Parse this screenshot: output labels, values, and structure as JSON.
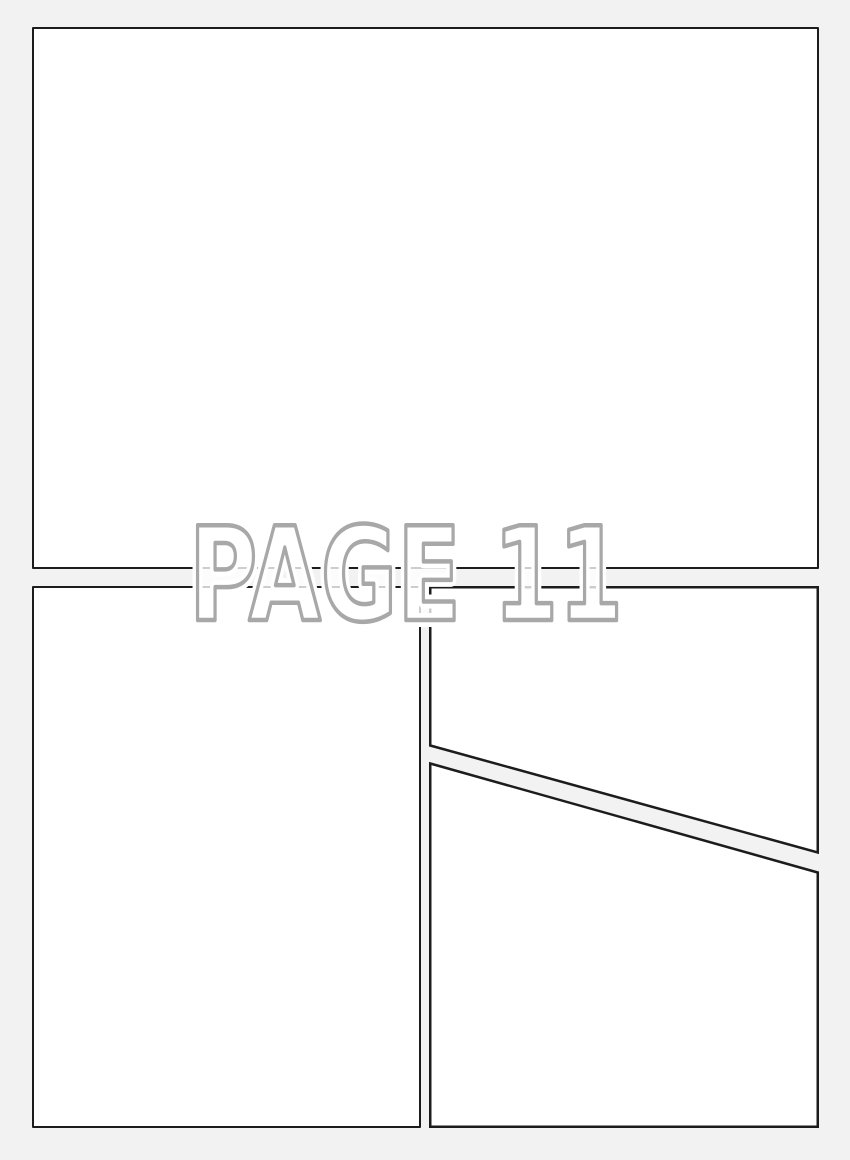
{
  "document": {
    "type": "comic-page-template",
    "title_text": "PAGE 11",
    "colors": {
      "background": "#f2f2f2",
      "panel_fill": "#ffffff",
      "panel_border": "#1c1c1c",
      "title_outline": "#a8a8a8",
      "title_fill": "rgba(255,255,255,0.78)",
      "title_halo": "#ffffff"
    },
    "panels": [
      {
        "name": "top-wide-panel",
        "content": ""
      },
      {
        "name": "bottom-left-panel",
        "content": ""
      },
      {
        "name": "bottom-right-upper-panel",
        "content": ""
      },
      {
        "name": "bottom-right-lower-panel",
        "content": ""
      }
    ]
  }
}
